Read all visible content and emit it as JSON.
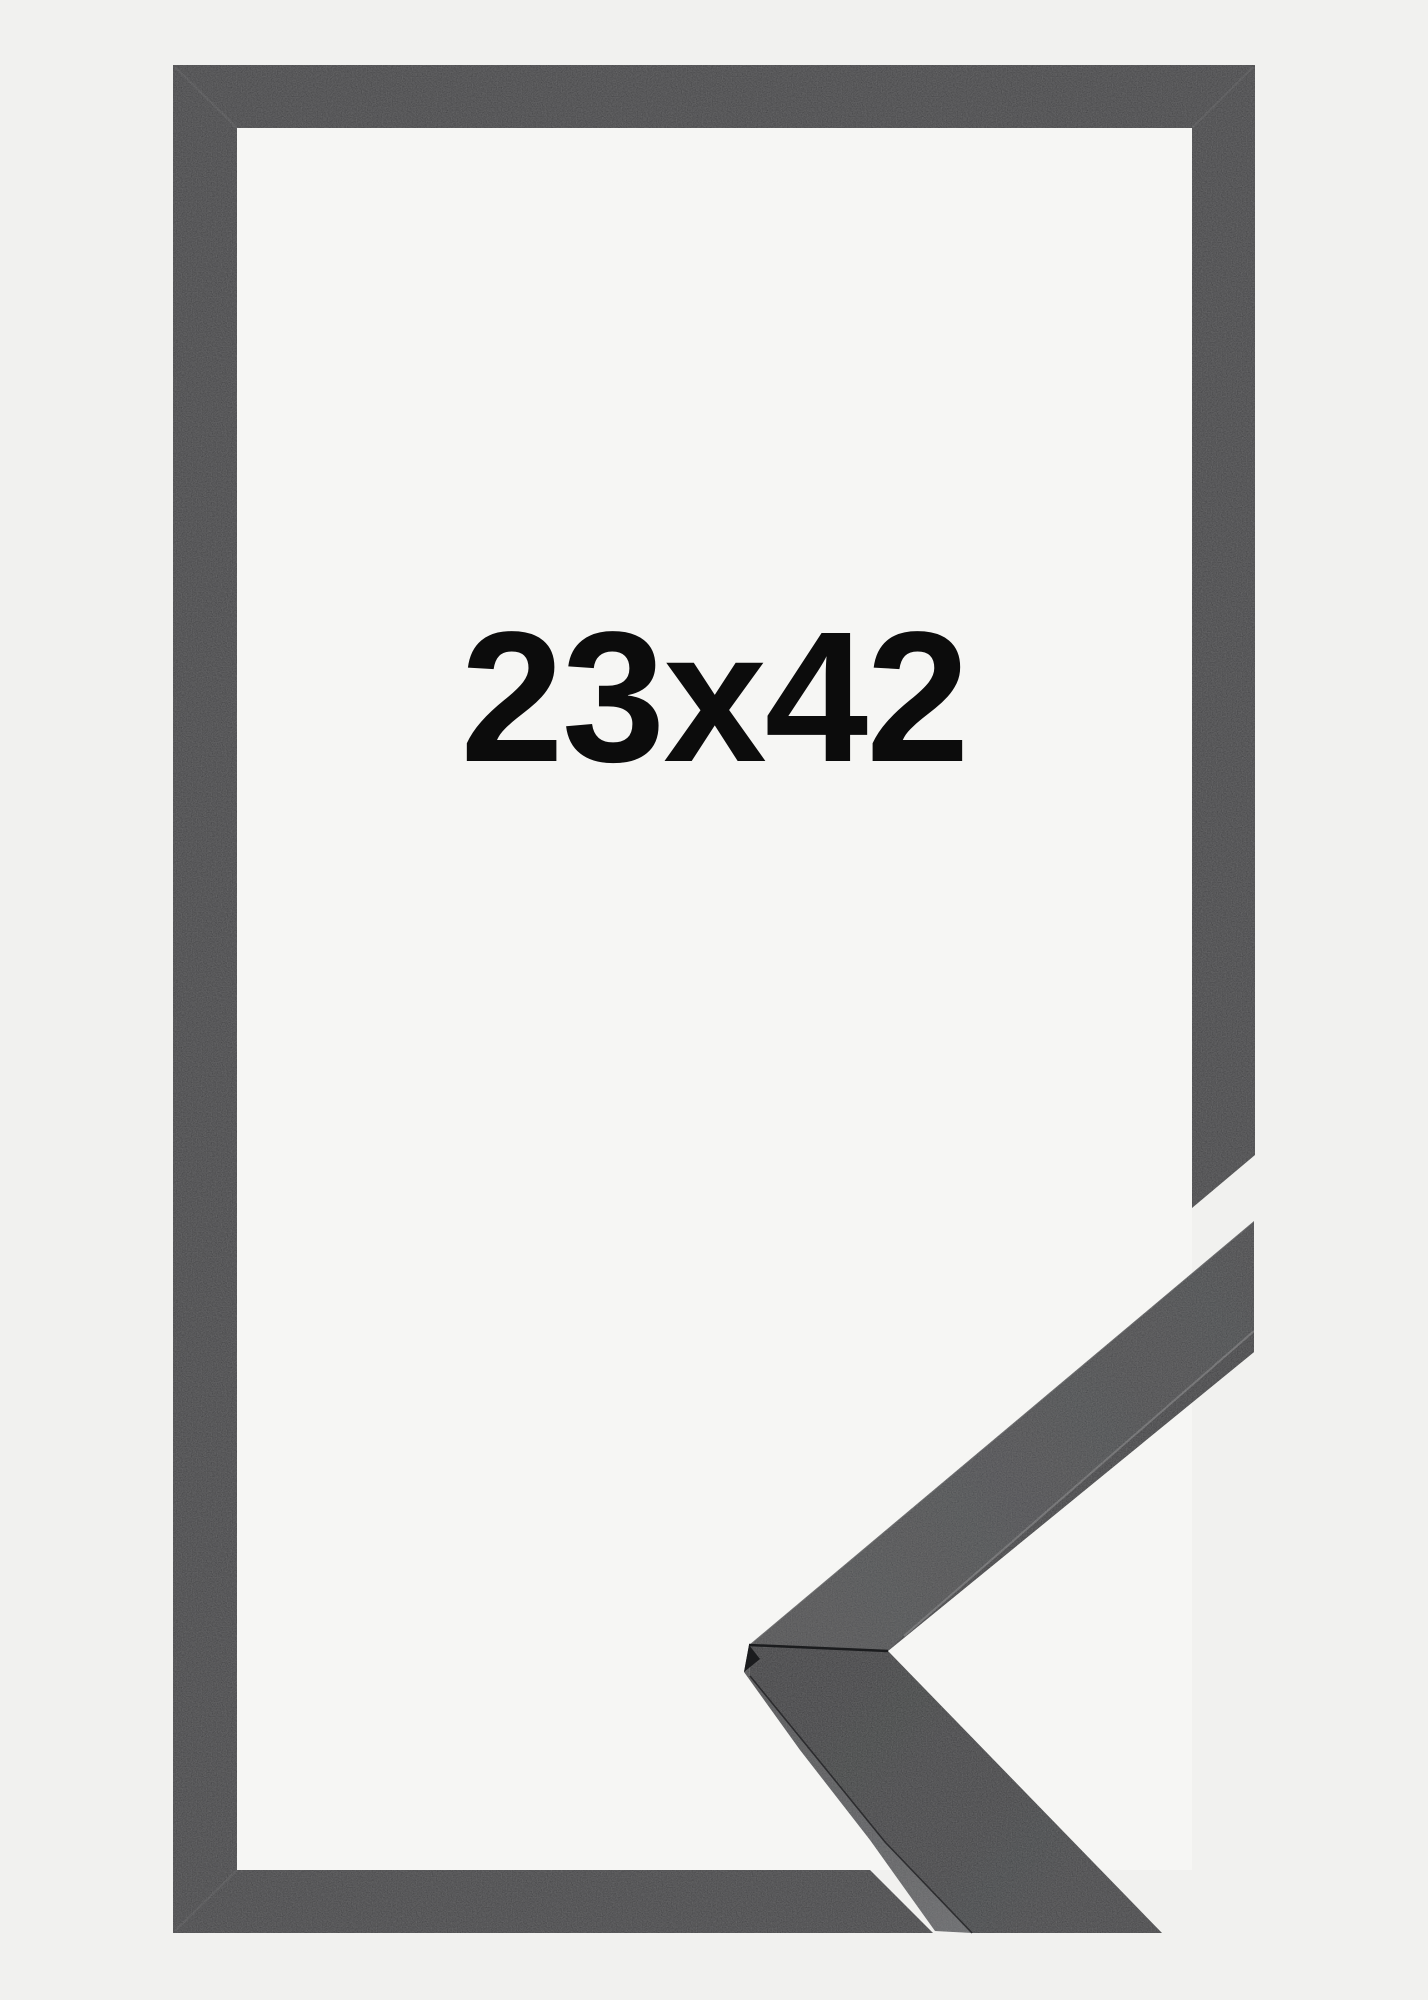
{
  "product_photo": {
    "size_label": "23x42"
  },
  "colors": {
    "background": "#f1f1ef",
    "frame_interior": "#f6f6f4",
    "frame": "#2e2f30",
    "corner_face_light": "#3d3e41",
    "corner_face_dark": "#323336",
    "lower_face_dark": "#26272a",
    "lower_face": "#2e2f32",
    "side_strip_light": "#5a5b5e",
    "side_strip_dark": "#3f4043",
    "inner_strip": "#2a2b2e",
    "seam_dark": "#1b1c1e",
    "text": "#0c0c0c"
  }
}
